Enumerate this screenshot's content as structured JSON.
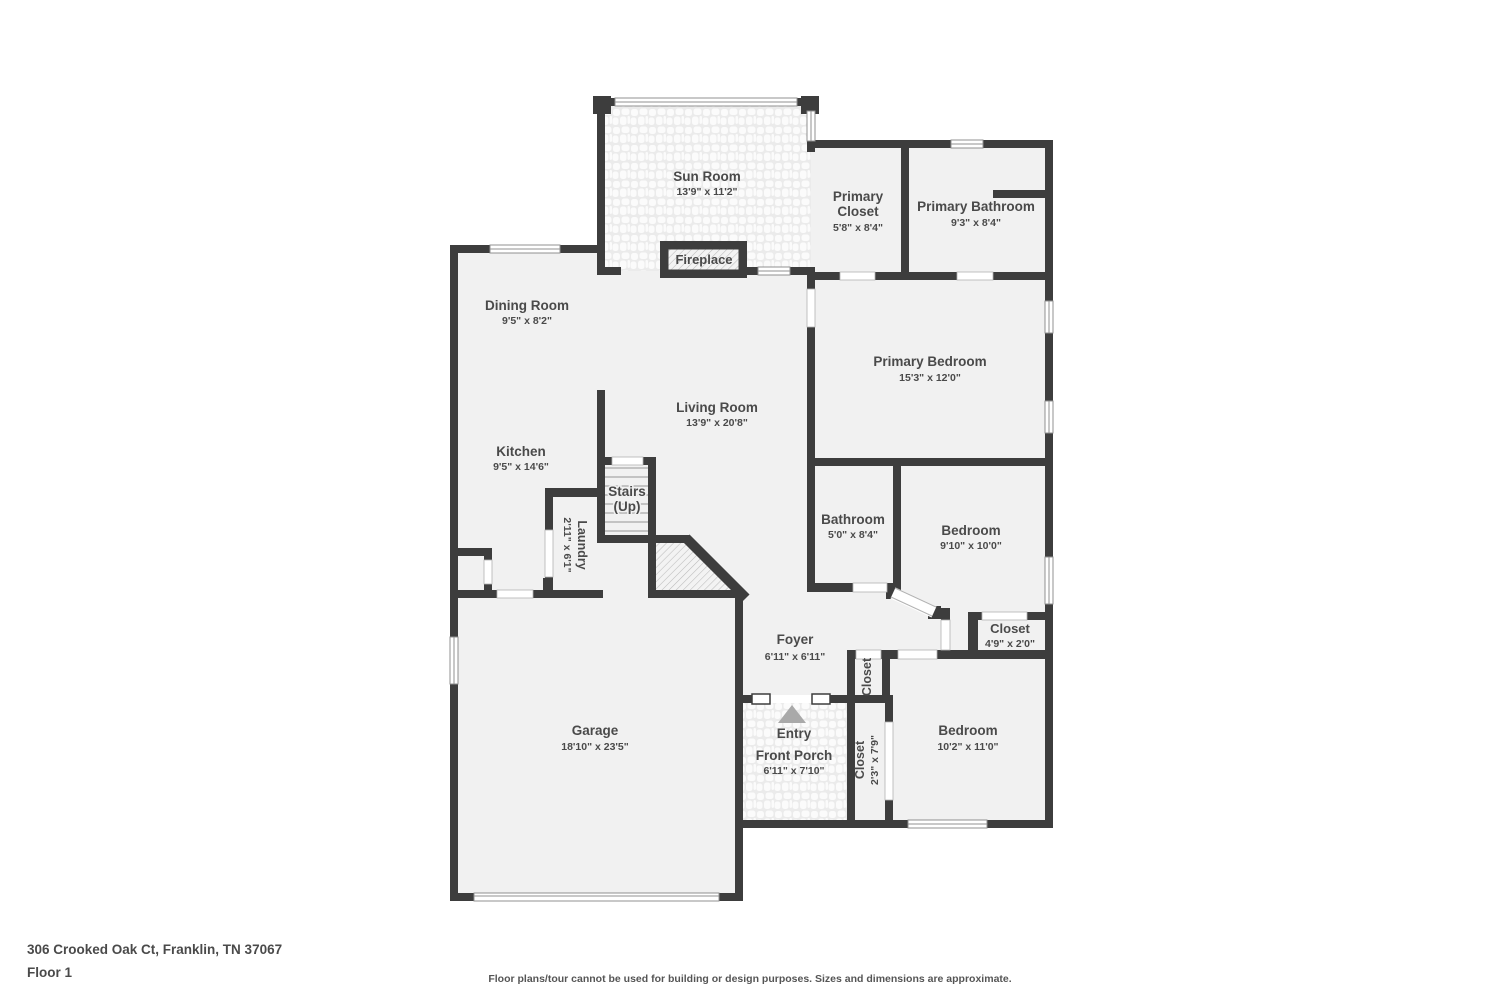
{
  "page": {
    "address": "306 Crooked Oak Ct, Franklin, TN 37067",
    "floor": "Floor 1",
    "disclaimer": "Floor plans/tour cannot be used for building or design purposes. Sizes and dimensions are approximate."
  },
  "colors": {
    "wall": "#3d3d3d",
    "floor": "#f1f1f1",
    "label": "#4a4a4a",
    "entry_arrow": "#a9a9a9"
  },
  "rooms": {
    "sun_room": {
      "name": "Sun Room",
      "dims": "13'9\" x 11'2\""
    },
    "fireplace": {
      "name": "Fireplace"
    },
    "primary_closet": {
      "line1": "Primary",
      "line2": "Closet",
      "dims": "5'8\" x 8'4\""
    },
    "primary_bathroom": {
      "name": "Primary Bathroom",
      "dims": "9'3\" x 8'4\""
    },
    "dining_room": {
      "name": "Dining Room",
      "dims": "9'5\" x 8'2\""
    },
    "primary_bedroom": {
      "name": "Primary Bedroom",
      "dims": "15'3\" x 12'0\""
    },
    "living_room": {
      "name": "Living Room",
      "dims": "13'9\" x 20'8\""
    },
    "kitchen": {
      "name": "Kitchen",
      "dims": "9'5\" x 14'6\""
    },
    "stairs": {
      "line1": "Stairs",
      "line2": "(Up)"
    },
    "laundry": {
      "name": "Laundry",
      "dims": "2'11\" x 6'1\""
    },
    "bathroom": {
      "name": "Bathroom",
      "dims": "5'0\" x 8'4\""
    },
    "bedroom_mid": {
      "name": "Bedroom",
      "dims": "9'10\" x 10'0\""
    },
    "closet_hall": {
      "name": "Closet",
      "dims": "4'9\" x 2'0\""
    },
    "foyer": {
      "name": "Foyer",
      "dims": "6'11\" x 6'11\""
    },
    "closet_foyer": {
      "name": "Closet"
    },
    "garage": {
      "name": "Garage",
      "dims": "18'10\" x 23'5\""
    },
    "entry": {
      "name": "Entry"
    },
    "front_porch": {
      "name": "Front Porch",
      "dims": "6'11\" x 7'10\""
    },
    "closet_bedroom": {
      "name": "Closet",
      "dims": "2'3\" x 7'9\""
    },
    "bedroom_lower": {
      "name": "Bedroom",
      "dims": "10'2\" x 11'0\""
    }
  }
}
